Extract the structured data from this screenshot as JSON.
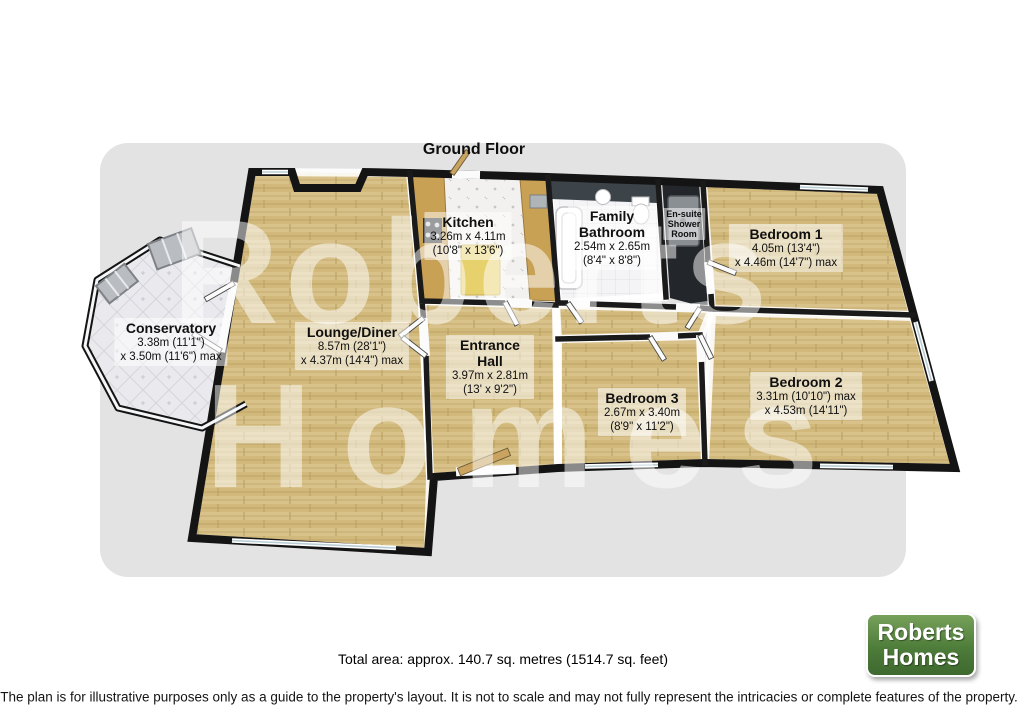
{
  "header": {
    "title": "Ground Floor"
  },
  "watermark": {
    "line1": "Roberts",
    "line2": "Homes"
  },
  "rooms": [
    {
      "id": "conservatory",
      "name_lines": [
        "Conservatory"
      ],
      "dims_lines": [
        "3.38m (11'1\")",
        "x 3.50m (11'6\") max"
      ]
    },
    {
      "id": "lounge-diner",
      "name_lines": [
        "Lounge/Diner"
      ],
      "dims_lines": [
        "8.57m (28'1\")",
        "x 4.37m (14'4\") max"
      ]
    },
    {
      "id": "kitchen",
      "name_lines": [
        "Kitchen"
      ],
      "dims_lines": [
        "3.26m x 4.11m",
        "(10'8\" x 13'6\")"
      ]
    },
    {
      "id": "entrance-hall",
      "name_lines": [
        "Entrance",
        "Hall"
      ],
      "dims_lines": [
        "3.97m x 2.81m",
        "(13' x 9'2\")"
      ]
    },
    {
      "id": "family-bathroom",
      "name_lines": [
        "Family",
        "Bathroom"
      ],
      "dims_lines": [
        "2.54m x 2.65m",
        "(8'4\" x 8'8\")"
      ]
    },
    {
      "id": "ensuite",
      "name_lines": [
        "En-suite",
        "Shower",
        "Room"
      ],
      "dims_lines": []
    },
    {
      "id": "bedroom-1",
      "name_lines": [
        "Bedroom 1"
      ],
      "dims_lines": [
        "4.05m (13'4\")",
        "x 4.46m (14'7\") max"
      ]
    },
    {
      "id": "bedroom-2",
      "name_lines": [
        "Bedroom 2"
      ],
      "dims_lines": [
        "3.31m (10'10\") max",
        "x 4.53m (14'11\")"
      ]
    },
    {
      "id": "bedroom-3",
      "name_lines": [
        "Bedroom 3"
      ],
      "dims_lines": [
        "2.67m x 3.40m",
        "(8'9\" x 11'2\")"
      ]
    }
  ],
  "footer": {
    "total_area": "Total area: approx. 140.7 sq. metres (1514.7 sq. feet)",
    "disclaimer": "The plan is for illustrative purposes only as a guide to the property's layout. It is not to scale and may not fully represent the intricacies or complete features of the property."
  },
  "logo": {
    "line1": "Roberts",
    "line2": "Homes"
  },
  "colors": {
    "panel_bg": "#e3e3e3",
    "wall": "#141414",
    "wood_floor": "#d8c28a",
    "conservatory_tile": "#eaeaee",
    "kitchen_counter": "#c8a155",
    "island": "#e7d16d",
    "ensuite_floor": "#23262a",
    "logo_green": "#4e7c3a",
    "logo_text": "#ffffff"
  }
}
